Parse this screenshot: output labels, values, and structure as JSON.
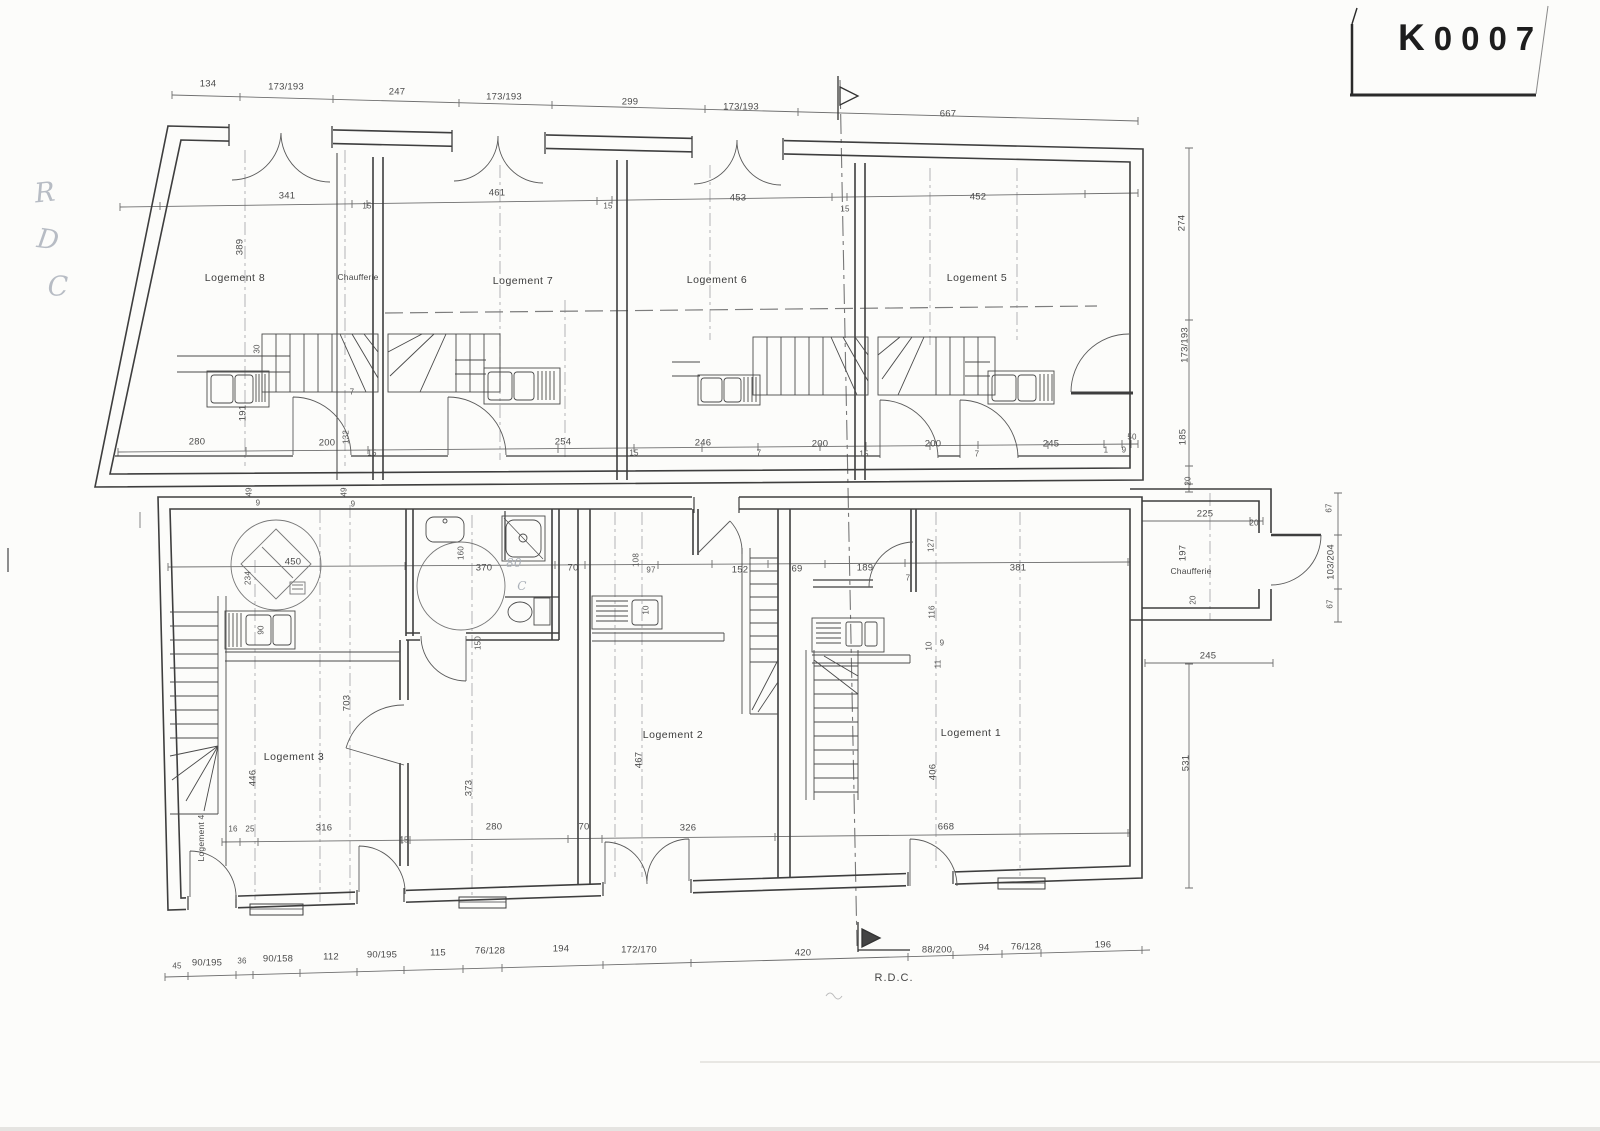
{
  "stamp": {
    "code": "K0007",
    "code_first": "K",
    "code_rest": "0007"
  },
  "plan": {
    "floor_label": "R.D.C.",
    "labels": [
      {
        "t": "Logement 8",
        "x": 235,
        "y": 278,
        "k": "room"
      },
      {
        "t": "Chaufferie",
        "x": 358,
        "y": 277,
        "k": "room-sm"
      },
      {
        "t": "Logement 7",
        "x": 523,
        "y": 281,
        "k": "room"
      },
      {
        "t": "Logement 6",
        "x": 717,
        "y": 280,
        "k": "room"
      },
      {
        "t": "Logement 5",
        "x": 977,
        "y": 278,
        "k": "room"
      },
      {
        "t": "Logement 3",
        "x": 294,
        "y": 757,
        "k": "room"
      },
      {
        "t": "Logement 2",
        "x": 673,
        "y": 735,
        "k": "room"
      },
      {
        "t": "Logement 1",
        "x": 971,
        "y": 733,
        "k": "room"
      },
      {
        "t": "Logement 4",
        "x": 201,
        "y": 838,
        "r": -90,
        "k": "room-sm"
      },
      {
        "t": "Chaufferie",
        "x": 1191,
        "y": 571,
        "k": "room-sm"
      },
      {
        "t": "134",
        "x": 208,
        "y": 84
      },
      {
        "t": "173/193",
        "x": 286,
        "y": 87
      },
      {
        "t": "247",
        "x": 397,
        "y": 92
      },
      {
        "t": "173/193",
        "x": 504,
        "y": 97
      },
      {
        "t": "299",
        "x": 630,
        "y": 102
      },
      {
        "t": "173/193",
        "x": 741,
        "y": 107
      },
      {
        "t": "667",
        "x": 948,
        "y": 114
      },
      {
        "t": "341",
        "x": 287,
        "y": 196
      },
      {
        "t": "15",
        "x": 367,
        "y": 206,
        "k": "sm"
      },
      {
        "t": "461",
        "x": 497,
        "y": 193
      },
      {
        "t": "15",
        "x": 608,
        "y": 206,
        "k": "sm"
      },
      {
        "t": "453",
        "x": 738,
        "y": 198
      },
      {
        "t": "15",
        "x": 845,
        "y": 209,
        "k": "sm"
      },
      {
        "t": "452",
        "x": 978,
        "y": 197
      },
      {
        "t": "389",
        "x": 240,
        "y": 247,
        "r": -90
      },
      {
        "t": "30",
        "x": 257,
        "y": 349,
        "r": -90,
        "k": "sm"
      },
      {
        "t": "191",
        "x": 243,
        "y": 413,
        "r": -90
      },
      {
        "t": "7",
        "x": 352,
        "y": 392,
        "k": "sm"
      },
      {
        "t": "132",
        "x": 346,
        "y": 437,
        "r": -90,
        "k": "sm"
      },
      {
        "t": "280",
        "x": 197,
        "y": 442
      },
      {
        "t": "200",
        "x": 327,
        "y": 443
      },
      {
        "t": "15",
        "x": 372,
        "y": 453,
        "k": "sm"
      },
      {
        "t": "254",
        "x": 563,
        "y": 442
      },
      {
        "t": "15",
        "x": 634,
        "y": 453,
        "k": "sm"
      },
      {
        "t": "246",
        "x": 703,
        "y": 443
      },
      {
        "t": "7",
        "x": 759,
        "y": 453,
        "k": "sm"
      },
      {
        "t": "200",
        "x": 820,
        "y": 444
      },
      {
        "t": "15",
        "x": 864,
        "y": 454,
        "k": "sm"
      },
      {
        "t": "200",
        "x": 933,
        "y": 444
      },
      {
        "t": "7",
        "x": 977,
        "y": 454,
        "k": "sm"
      },
      {
        "t": "245",
        "x": 1051,
        "y": 444
      },
      {
        "t": "1",
        "x": 1106,
        "y": 450,
        "k": "sm"
      },
      {
        "t": "9",
        "x": 1124,
        "y": 450,
        "k": "sm"
      },
      {
        "t": "50",
        "x": 1132,
        "y": 437,
        "k": "sm"
      },
      {
        "t": "274",
        "x": 1182,
        "y": 223,
        "r": -90
      },
      {
        "t": "173/193",
        "x": 1185,
        "y": 345,
        "r": -90
      },
      {
        "t": "185",
        "x": 1183,
        "y": 437,
        "r": -90
      },
      {
        "t": "20",
        "x": 1188,
        "y": 481,
        "r": -90,
        "k": "sm"
      },
      {
        "t": "531",
        "x": 1186,
        "y": 763,
        "r": -90
      },
      {
        "t": "245",
        "x": 1208,
        "y": 656
      },
      {
        "t": "225",
        "x": 1205,
        "y": 514
      },
      {
        "t": "20",
        "x": 1254,
        "y": 523,
        "k": "sm"
      },
      {
        "t": "197",
        "x": 1183,
        "y": 553,
        "r": -90
      },
      {
        "t": "20",
        "x": 1193,
        "y": 600,
        "r": -90,
        "k": "sm"
      },
      {
        "t": "67",
        "x": 1329,
        "y": 508,
        "r": -90,
        "k": "sm"
      },
      {
        "t": "103/204",
        "x": 1331,
        "y": 562,
        "r": -90
      },
      {
        "t": "67",
        "x": 1330,
        "y": 604,
        "r": -90,
        "k": "sm"
      },
      {
        "t": "49",
        "x": 249,
        "y": 492,
        "r": -90,
        "k": "sm"
      },
      {
        "t": "9",
        "x": 258,
        "y": 503,
        "k": "sm"
      },
      {
        "t": "49",
        "x": 344,
        "y": 492,
        "r": -90,
        "k": "sm"
      },
      {
        "t": "9",
        "x": 353,
        "y": 504,
        "k": "sm"
      },
      {
        "t": "450",
        "x": 293,
        "y": 562
      },
      {
        "t": "234",
        "x": 248,
        "y": 578,
        "r": -90,
        "k": "sm"
      },
      {
        "t": "160",
        "x": 461,
        "y": 553,
        "r": -90,
        "k": "sm"
      },
      {
        "t": "370",
        "x": 484,
        "y": 568
      },
      {
        "t": "70",
        "x": 573,
        "y": 568
      },
      {
        "t": "108",
        "x": 636,
        "y": 560,
        "r": -90,
        "k": "sm"
      },
      {
        "t": "97",
        "x": 651,
        "y": 570,
        "k": "sm"
      },
      {
        "t": "152",
        "x": 740,
        "y": 570
      },
      {
        "t": "69",
        "x": 797,
        "y": 569
      },
      {
        "t": "189",
        "x": 865,
        "y": 568
      },
      {
        "t": "7",
        "x": 908,
        "y": 578,
        "k": "sm"
      },
      {
        "t": "127",
        "x": 931,
        "y": 545,
        "r": -90,
        "k": "sm"
      },
      {
        "t": "381",
        "x": 1018,
        "y": 568
      },
      {
        "t": "116",
        "x": 932,
        "y": 612,
        "r": -90,
        "k": "sm"
      },
      {
        "t": "10",
        "x": 929,
        "y": 646,
        "r": -90,
        "k": "sm"
      },
      {
        "t": "9",
        "x": 942,
        "y": 643,
        "k": "sm"
      },
      {
        "t": "11",
        "x": 938,
        "y": 664,
        "r": -90,
        "k": "sm"
      },
      {
        "t": "150",
        "x": 478,
        "y": 643,
        "r": -90,
        "k": "sm"
      },
      {
        "t": "90",
        "x": 261,
        "y": 630,
        "r": -90,
        "k": "sm"
      },
      {
        "t": "10",
        "x": 646,
        "y": 610,
        "r": -90,
        "k": "sm"
      },
      {
        "t": "703",
        "x": 347,
        "y": 703,
        "r": -90
      },
      {
        "t": "446",
        "x": 253,
        "y": 778,
        "r": -90
      },
      {
        "t": "373",
        "x": 469,
        "y": 788,
        "r": -90
      },
      {
        "t": "467",
        "x": 639,
        "y": 760,
        "r": -90
      },
      {
        "t": "406",
        "x": 933,
        "y": 772,
        "r": -90
      },
      {
        "t": "16",
        "x": 233,
        "y": 829,
        "k": "sm"
      },
      {
        "t": "25",
        "x": 250,
        "y": 829,
        "k": "sm"
      },
      {
        "t": "316",
        "x": 324,
        "y": 828
      },
      {
        "t": "15",
        "x": 404,
        "y": 840,
        "k": "sm"
      },
      {
        "t": "280",
        "x": 494,
        "y": 827
      },
      {
        "t": "70",
        "x": 584,
        "y": 827
      },
      {
        "t": "326",
        "x": 688,
        "y": 828
      },
      {
        "t": "668",
        "x": 946,
        "y": 827
      },
      {
        "t": "45",
        "x": 177,
        "y": 966,
        "k": "sm"
      },
      {
        "t": "90/195",
        "x": 207,
        "y": 963
      },
      {
        "t": "36",
        "x": 242,
        "y": 961,
        "k": "sm"
      },
      {
        "t": "90/158",
        "x": 278,
        "y": 959
      },
      {
        "t": "112",
        "x": 331,
        "y": 957
      },
      {
        "t": "90/195",
        "x": 382,
        "y": 955
      },
      {
        "t": "115",
        "x": 438,
        "y": 953
      },
      {
        "t": "76/128",
        "x": 490,
        "y": 951
      },
      {
        "t": "194",
        "x": 561,
        "y": 949
      },
      {
        "t": "172/170",
        "x": 639,
        "y": 950
      },
      {
        "t": "420",
        "x": 803,
        "y": 953
      },
      {
        "t": "88/200",
        "x": 937,
        "y": 950
      },
      {
        "t": "94",
        "x": 984,
        "y": 948
      },
      {
        "t": "76/128",
        "x": 1026,
        "y": 947
      },
      {
        "t": "196",
        "x": 1103,
        "y": 945
      },
      {
        "t": "R",
        "x": 45,
        "y": 193,
        "r": -6,
        "k": "pencil"
      },
      {
        "t": "D",
        "x": 48,
        "y": 240,
        "r": 8,
        "k": "pencil"
      },
      {
        "t": "C",
        "x": 58,
        "y": 287,
        "k": "pencil"
      },
      {
        "t": "80",
        "x": 514,
        "y": 563,
        "k": "pencil-sm"
      },
      {
        "t": "C",
        "x": 522,
        "y": 586,
        "k": "pencil-sm"
      }
    ]
  }
}
